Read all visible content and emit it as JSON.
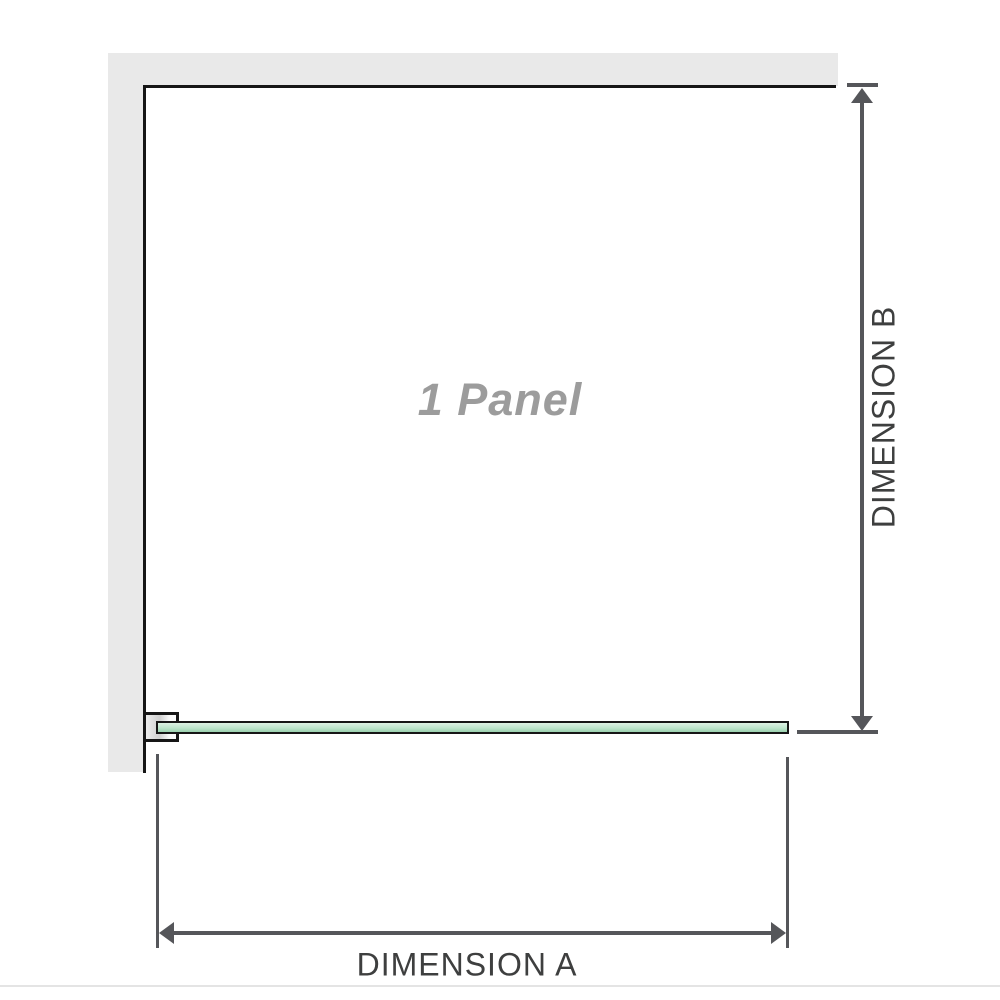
{
  "diagram": {
    "panel_label": "1 Panel",
    "dimension_a_label": "DIMENSION A",
    "dimension_b_label": "DIMENSION B",
    "colors": {
      "wall": "#e9e9e9",
      "outline": "#161616",
      "dimension_line": "#55565a",
      "dimension_text": "#3e3f3f",
      "panel_label_color": "#9c9c9c",
      "glass_top": "#ddf1e4",
      "glass_bottom": "#9bd2af"
    }
  }
}
